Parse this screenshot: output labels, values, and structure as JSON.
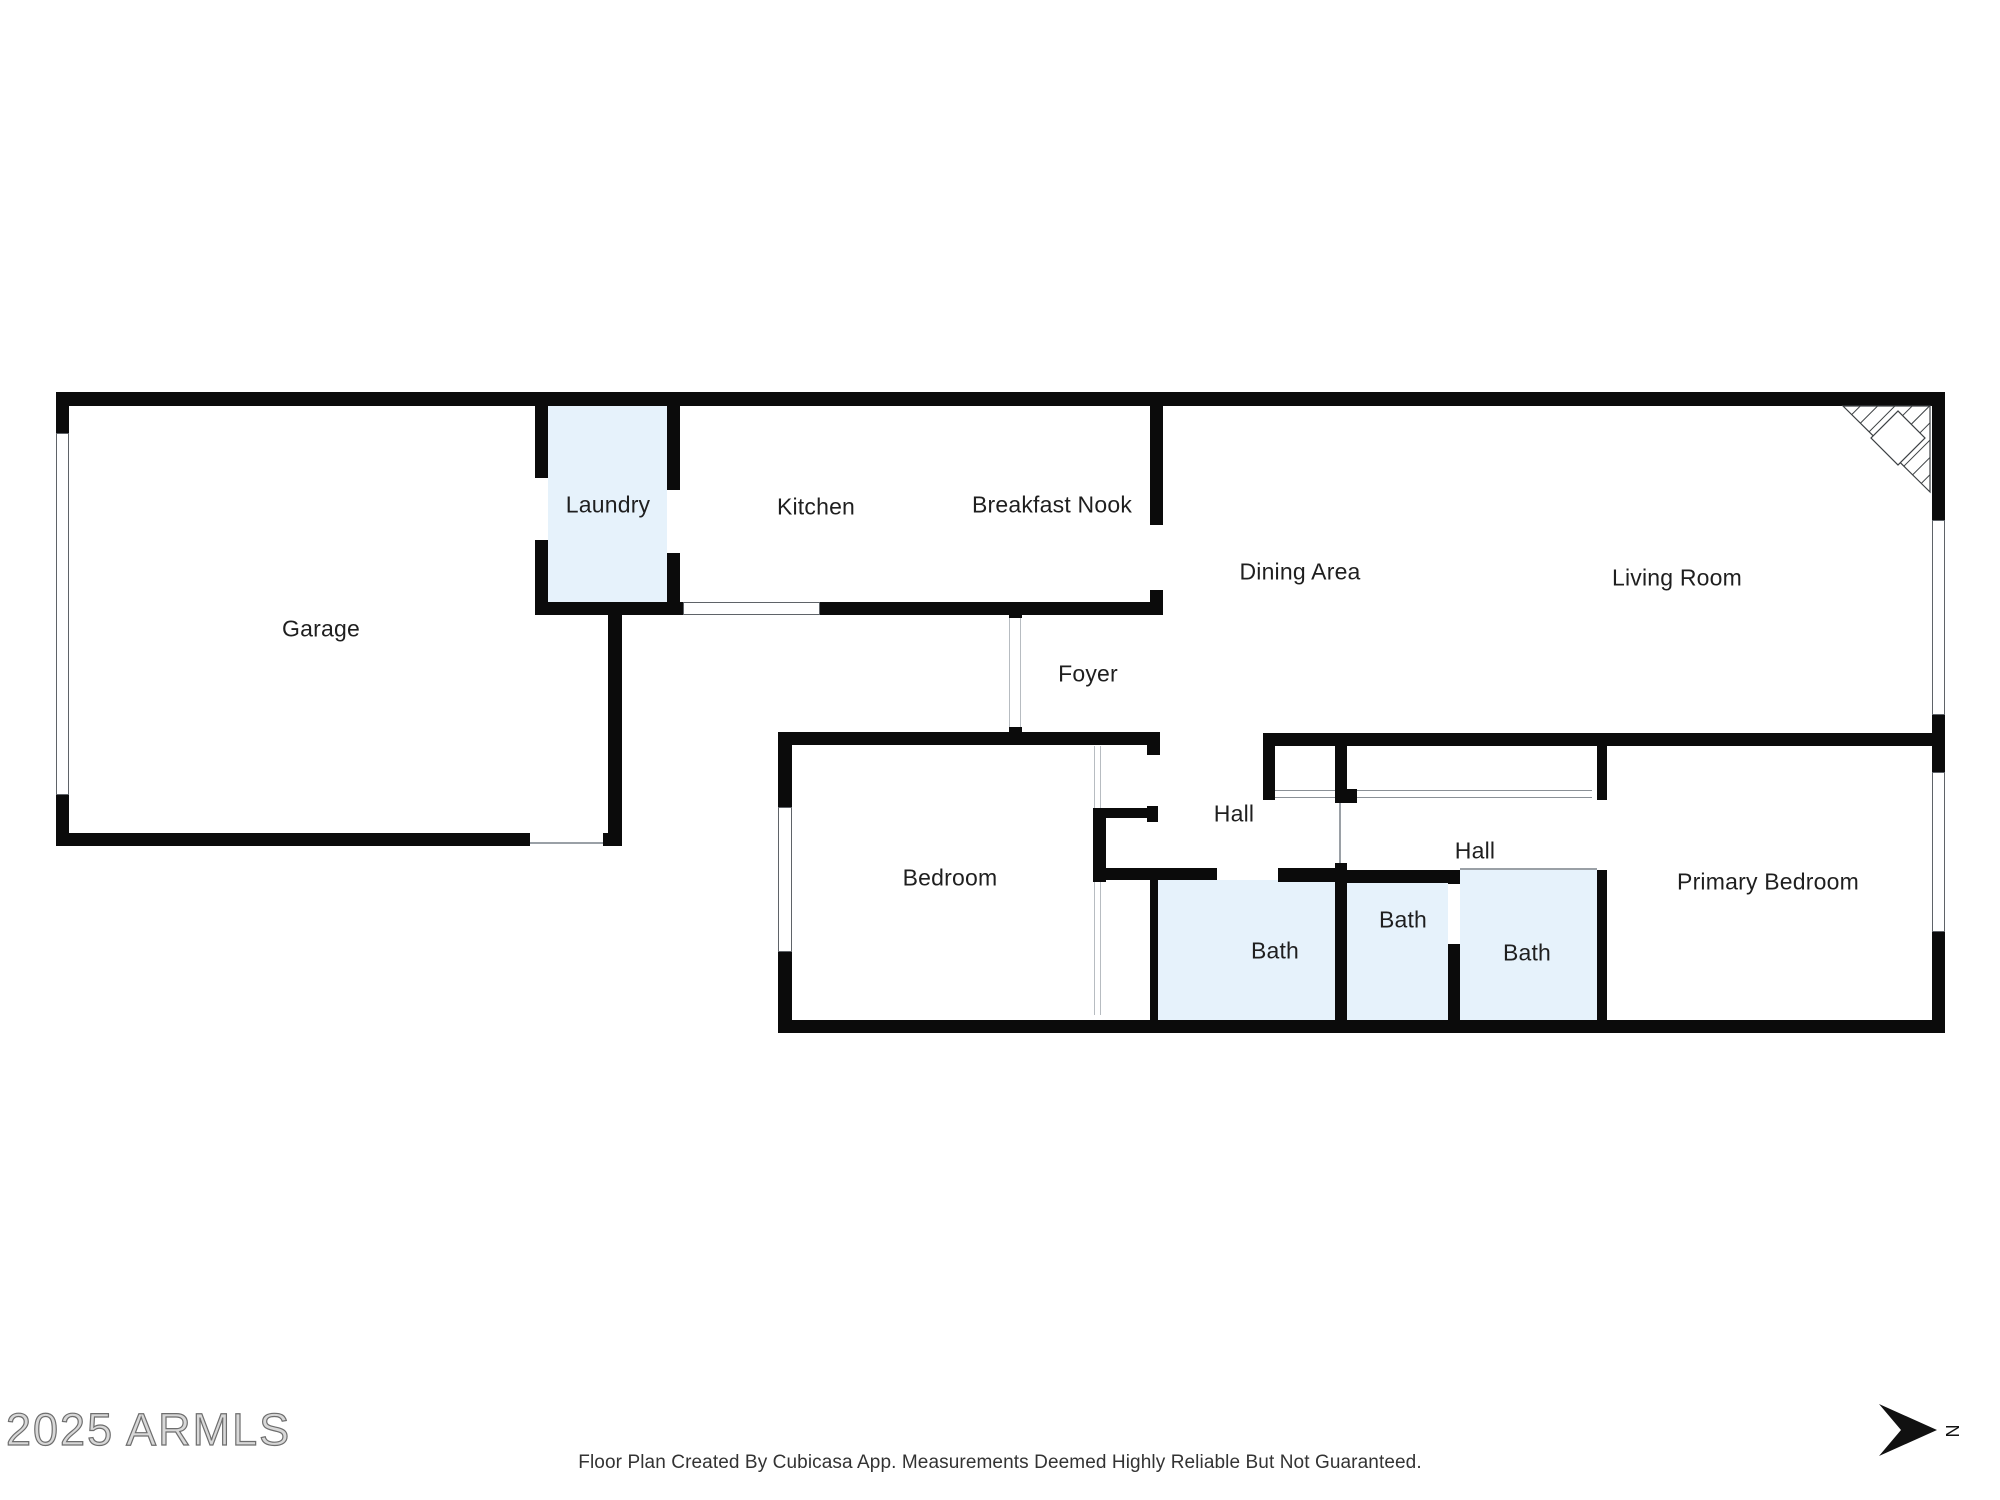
{
  "page": {
    "watermark": "2025 ARMLS",
    "disclaimer": "Floor Plan Created By Cubicasa App. Measurements Deemed Highly Reliable But Not Guaranteed.",
    "north_label": "N"
  },
  "colors": {
    "wall": "#0b0b0b",
    "room_fill": "#e6f2fb",
    "label": "#1f1f1f",
    "thin_line": "#9aa0a6",
    "arrow": "#111111"
  },
  "rooms": [
    {
      "id": "garage",
      "label": "Garage",
      "cx": 321,
      "cy": 629
    },
    {
      "id": "laundry",
      "label": "Laundry",
      "cx": 608,
      "cy": 505
    },
    {
      "id": "kitchen",
      "label": "Kitchen",
      "cx": 816,
      "cy": 507
    },
    {
      "id": "breakfast-nook",
      "label": "Breakfast Nook",
      "cx": 1052,
      "cy": 505
    },
    {
      "id": "dining-area",
      "label": "Dining Area",
      "cx": 1300,
      "cy": 572
    },
    {
      "id": "living-room",
      "label": "Living Room",
      "cx": 1677,
      "cy": 578
    },
    {
      "id": "foyer",
      "label": "Foyer",
      "cx": 1088,
      "cy": 674
    },
    {
      "id": "bedroom",
      "label": "Bedroom",
      "cx": 950,
      "cy": 878
    },
    {
      "id": "hall-1",
      "label": "Hall",
      "cx": 1234,
      "cy": 814
    },
    {
      "id": "hall-2",
      "label": "Hall",
      "cx": 1475,
      "cy": 851
    },
    {
      "id": "bath-1",
      "label": "Bath",
      "cx": 1275,
      "cy": 951
    },
    {
      "id": "bath-2",
      "label": "Bath",
      "cx": 1403,
      "cy": 920
    },
    {
      "id": "bath-3",
      "label": "Bath",
      "cx": 1527,
      "cy": 953
    },
    {
      "id": "primary-bedroom",
      "label": "Primary Bedroom",
      "cx": 1768,
      "cy": 882
    }
  ],
  "blue_areas": [
    {
      "x": 548,
      "y": 406,
      "w": 119,
      "h": 196
    },
    {
      "x": 1158,
      "y": 880,
      "w": 177,
      "h": 140
    },
    {
      "x": 1347,
      "y": 883,
      "w": 101,
      "h": 137
    },
    {
      "x": 1460,
      "y": 870,
      "w": 137,
      "h": 150
    }
  ],
  "walls": [
    {
      "x": 56,
      "y": 392,
      "w": 1888,
      "h": 14
    },
    {
      "x": 56,
      "y": 392,
      "w": 13,
      "h": 41
    },
    {
      "x": 56,
      "y": 795,
      "w": 13,
      "h": 51
    },
    {
      "x": 56,
      "y": 833,
      "w": 474,
      "h": 13
    },
    {
      "x": 603,
      "y": 833,
      "w": 19,
      "h": 13
    },
    {
      "x": 608,
      "y": 613,
      "w": 14,
      "h": 233
    },
    {
      "x": 535,
      "y": 392,
      "w": 13,
      "h": 86
    },
    {
      "x": 535,
      "y": 540,
      "w": 13,
      "h": 75
    },
    {
      "x": 667,
      "y": 392,
      "w": 13,
      "h": 98
    },
    {
      "x": 667,
      "y": 553,
      "w": 13,
      "h": 62
    },
    {
      "x": 535,
      "y": 602,
      "w": 148,
      "h": 13
    },
    {
      "x": 820,
      "y": 602,
      "w": 343,
      "h": 13
    },
    {
      "x": 1150,
      "y": 406,
      "w": 13,
      "h": 119
    },
    {
      "x": 1150,
      "y": 590,
      "w": 13,
      "h": 25
    },
    {
      "x": 1932,
      "y": 392,
      "w": 13,
      "h": 128
    },
    {
      "x": 1932,
      "y": 715,
      "w": 13,
      "h": 57
    },
    {
      "x": 1932,
      "y": 932,
      "w": 13,
      "h": 101
    },
    {
      "x": 1263,
      "y": 733,
      "w": 669,
      "h": 13
    },
    {
      "x": 1263,
      "y": 733,
      "w": 12,
      "h": 67
    },
    {
      "x": 1335,
      "y": 733,
      "w": 12,
      "h": 70
    },
    {
      "x": 1335,
      "y": 789,
      "w": 22,
      "h": 14
    },
    {
      "x": 1597,
      "y": 733,
      "w": 10,
      "h": 67
    },
    {
      "x": 1335,
      "y": 863,
      "w": 12,
      "h": 170
    },
    {
      "x": 1597,
      "y": 870,
      "w": 10,
      "h": 163
    },
    {
      "x": 778,
      "y": 1020,
      "w": 1166,
      "h": 13
    },
    {
      "x": 778,
      "y": 732,
      "w": 380,
      "h": 13
    },
    {
      "x": 1147,
      "y": 732,
      "w": 13,
      "h": 23
    },
    {
      "x": 778,
      "y": 732,
      "w": 14,
      "h": 75
    },
    {
      "x": 778,
      "y": 952,
      "w": 14,
      "h": 81
    },
    {
      "x": 1093,
      "y": 808,
      "w": 13,
      "h": 74
    },
    {
      "x": 1106,
      "y": 808,
      "w": 52,
      "h": 10
    },
    {
      "x": 1147,
      "y": 806,
      "w": 11,
      "h": 16
    },
    {
      "x": 1093,
      "y": 868,
      "w": 124,
      "h": 12
    },
    {
      "x": 1150,
      "y": 868,
      "w": 8,
      "h": 165
    },
    {
      "x": 1278,
      "y": 868,
      "w": 57,
      "h": 14
    },
    {
      "x": 1347,
      "y": 870,
      "w": 101,
      "h": 13
    },
    {
      "x": 1448,
      "y": 870,
      "w": 12,
      "h": 14
    },
    {
      "x": 1448,
      "y": 944,
      "w": 12,
      "h": 89
    },
    {
      "x": 1009,
      "y": 607,
      "w": 13,
      "h": 11
    },
    {
      "x": 1009,
      "y": 727,
      "w": 13,
      "h": 18
    }
  ],
  "windows": [
    {
      "x": 56,
      "y": 433,
      "w": 13,
      "h": 362
    },
    {
      "x": 683,
      "y": 602,
      "w": 137,
      "h": 13
    },
    {
      "x": 778,
      "y": 807,
      "w": 14,
      "h": 145
    },
    {
      "x": 1932,
      "y": 520,
      "w": 13,
      "h": 195
    },
    {
      "x": 1932,
      "y": 772,
      "w": 13,
      "h": 160
    }
  ],
  "openings": [
    {
      "x": 1275,
      "y": 790,
      "w": 60,
      "h": 8,
      "o": "h"
    },
    {
      "x": 1357,
      "y": 790,
      "w": 235,
      "h": 8,
      "o": "h"
    },
    {
      "x": 1009,
      "y": 618,
      "w": 12,
      "h": 109,
      "o": "v"
    },
    {
      "x": 1094,
      "y": 746,
      "w": 7,
      "h": 62,
      "o": "v"
    },
    {
      "x": 1094,
      "y": 882,
      "w": 7,
      "h": 133,
      "o": "v"
    }
  ],
  "thin_lines": [
    {
      "x": 530,
      "y": 842,
      "w": 73,
      "h": 2
    },
    {
      "x": 1339,
      "y": 803,
      "w": 2,
      "h": 60
    },
    {
      "x": 1460,
      "y": 868,
      "w": 137,
      "h": 2
    }
  ],
  "fireplace": {
    "triangle": [
      [
        1843,
        406
      ],
      [
        1930,
        406
      ],
      [
        1930,
        492
      ]
    ],
    "hatch_count": 9,
    "diamond": {
      "cx": 1898,
      "cy": 438,
      "r": 27
    }
  },
  "north_arrow": {
    "polygon": [
      [
        1937,
        1430
      ],
      [
        1879,
        1404
      ],
      [
        1901,
        1430
      ],
      [
        1879,
        1456
      ]
    ],
    "label_x": 1952,
    "label_y": 1431
  }
}
